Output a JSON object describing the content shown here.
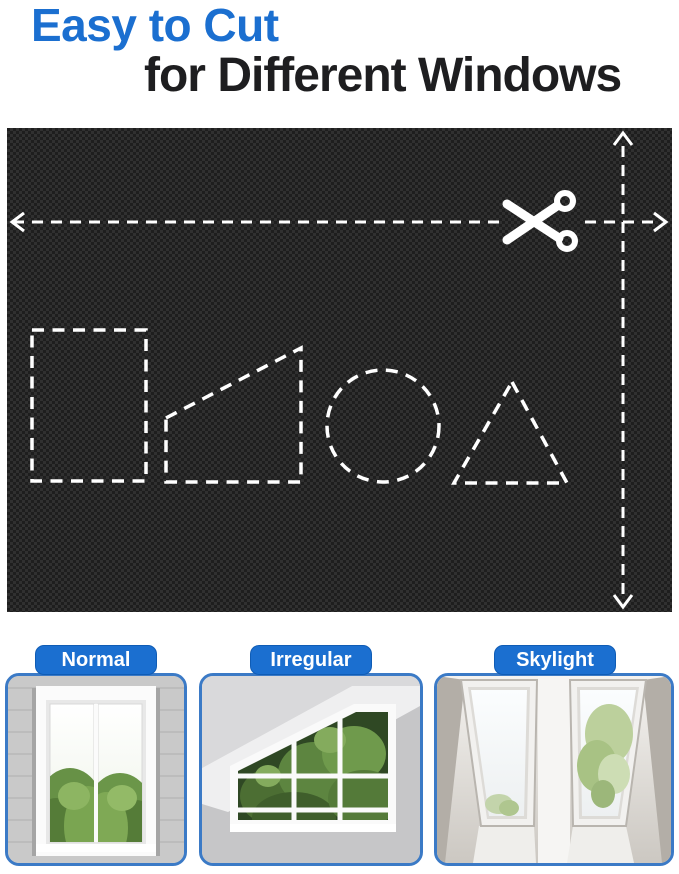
{
  "title": {
    "line1": "Easy to Cut",
    "line2": "for Different Windows"
  },
  "fabric_panel": {
    "cut_shapes": [
      "rectangle",
      "trapezoid",
      "circle",
      "triangle"
    ],
    "icons": [
      "scissors-icon",
      "arrow-left-icon",
      "arrow-right-icon",
      "arrow-up-icon",
      "arrow-down-icon"
    ]
  },
  "window_cards": [
    {
      "label": "Normal"
    },
    {
      "label": "Irregular"
    },
    {
      "label": "Skylight"
    }
  ],
  "colors": {
    "accent_blue": "#1b6fd0",
    "title_text": "#1e1e20",
    "fabric_black": "#1f1f1f",
    "card_border": "#3b7ac6",
    "dash_lines": "#ffffff",
    "label_text": "#ffffff"
  }
}
